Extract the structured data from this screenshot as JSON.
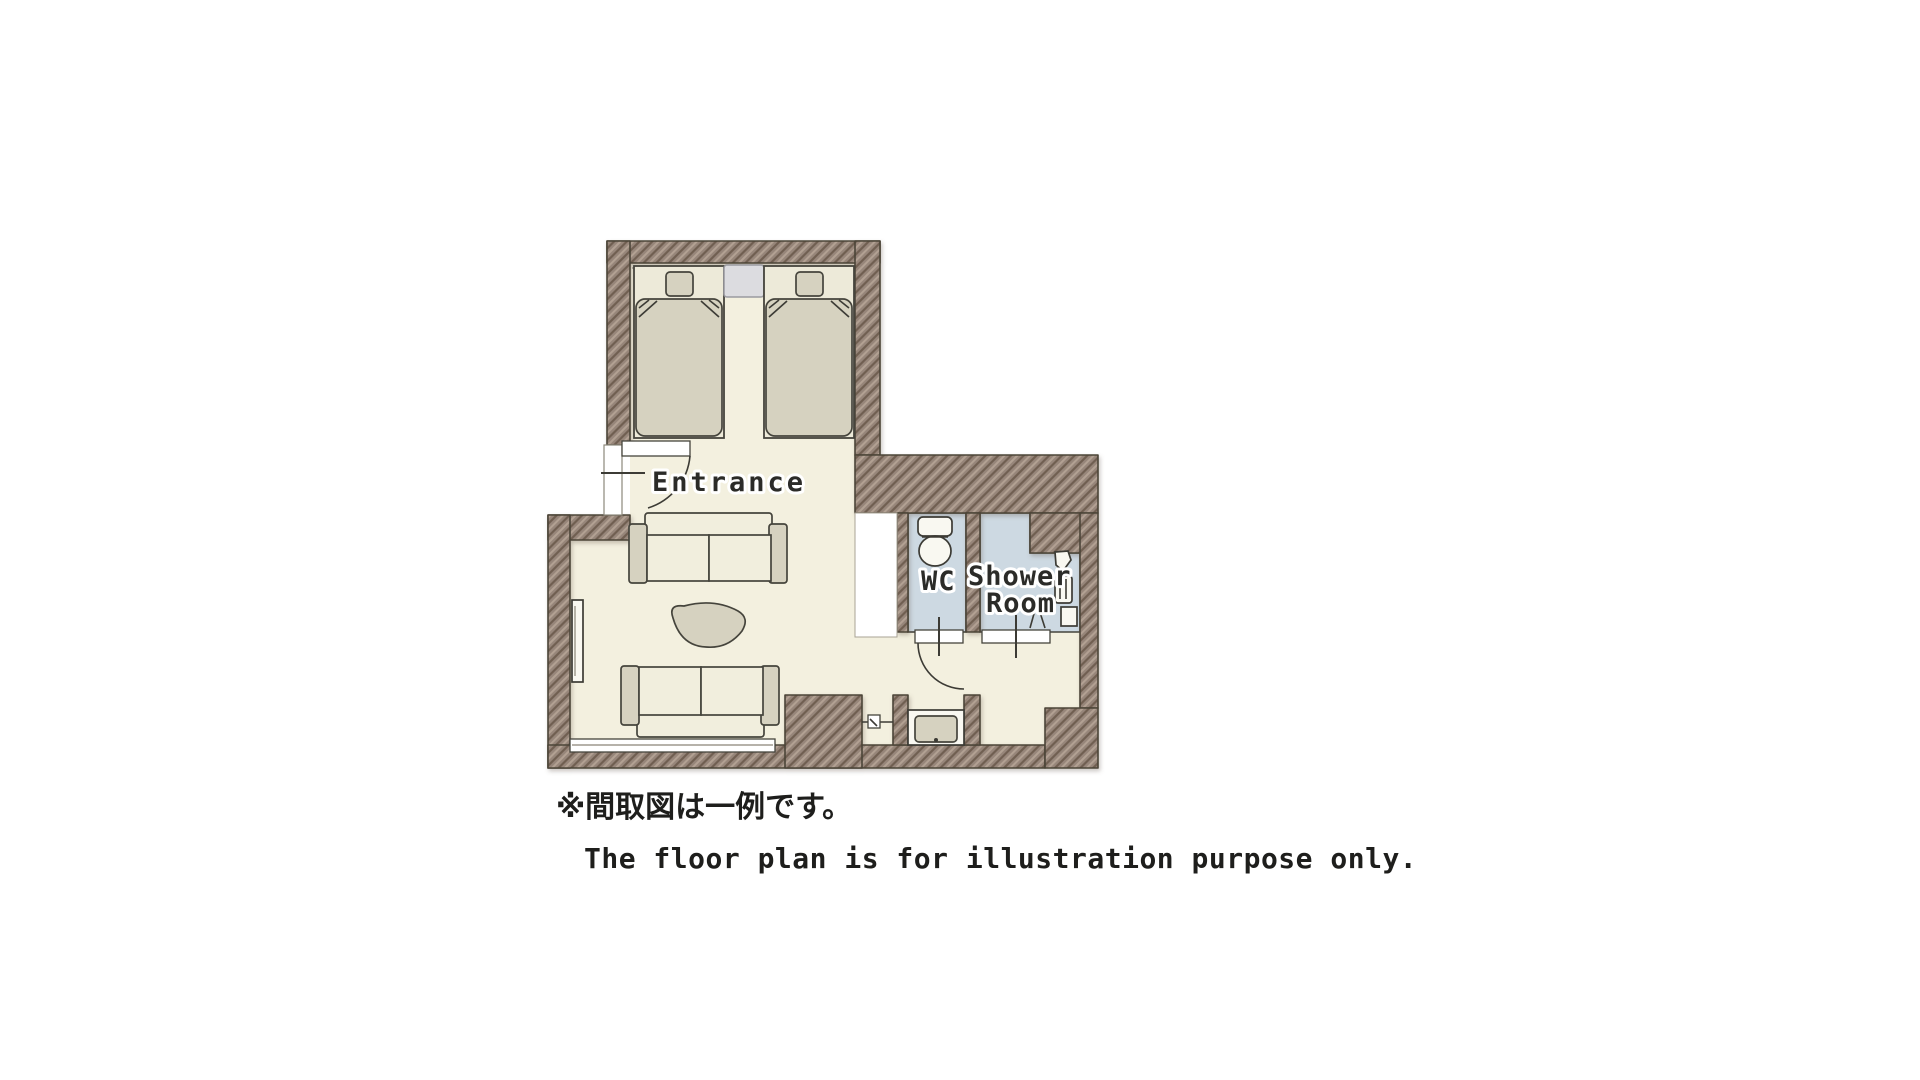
{
  "page": {
    "background": "#ffffff"
  },
  "floor_plan": {
    "labels": {
      "entrance": "Entrance",
      "wc": "WC",
      "shower_room_line1": "Shower",
      "shower_room_line2": "Room"
    },
    "notes": {
      "japanese": "※間取図は一例です。",
      "english": "The floor plan is for illustration purpose only."
    },
    "colors": {
      "wall_base": "#97867a",
      "wall_hatch_dark": "#6f5e51",
      "wall_hatch_light": "#b2a193",
      "wall_outline": "#4c4437",
      "floor": "#f3f0df",
      "wet_room": "#cdd9e2",
      "furniture_light": "#f1eedd",
      "furniture_shade": "#d6d2c0",
      "bed_surface": "#edead9",
      "nightstand": "#dcdce0",
      "fixture_white": "#f9f8f1",
      "outline": "#45443c",
      "text": "#2b2b28"
    },
    "fixtures": [
      "bed",
      "bed",
      "nightstand",
      "sofa",
      "sofa",
      "coffee-table",
      "tv",
      "tv-board",
      "toilet",
      "washing-machine",
      "shower-unit",
      "entrance-door",
      "wc-door",
      "shower-threshold"
    ]
  }
}
